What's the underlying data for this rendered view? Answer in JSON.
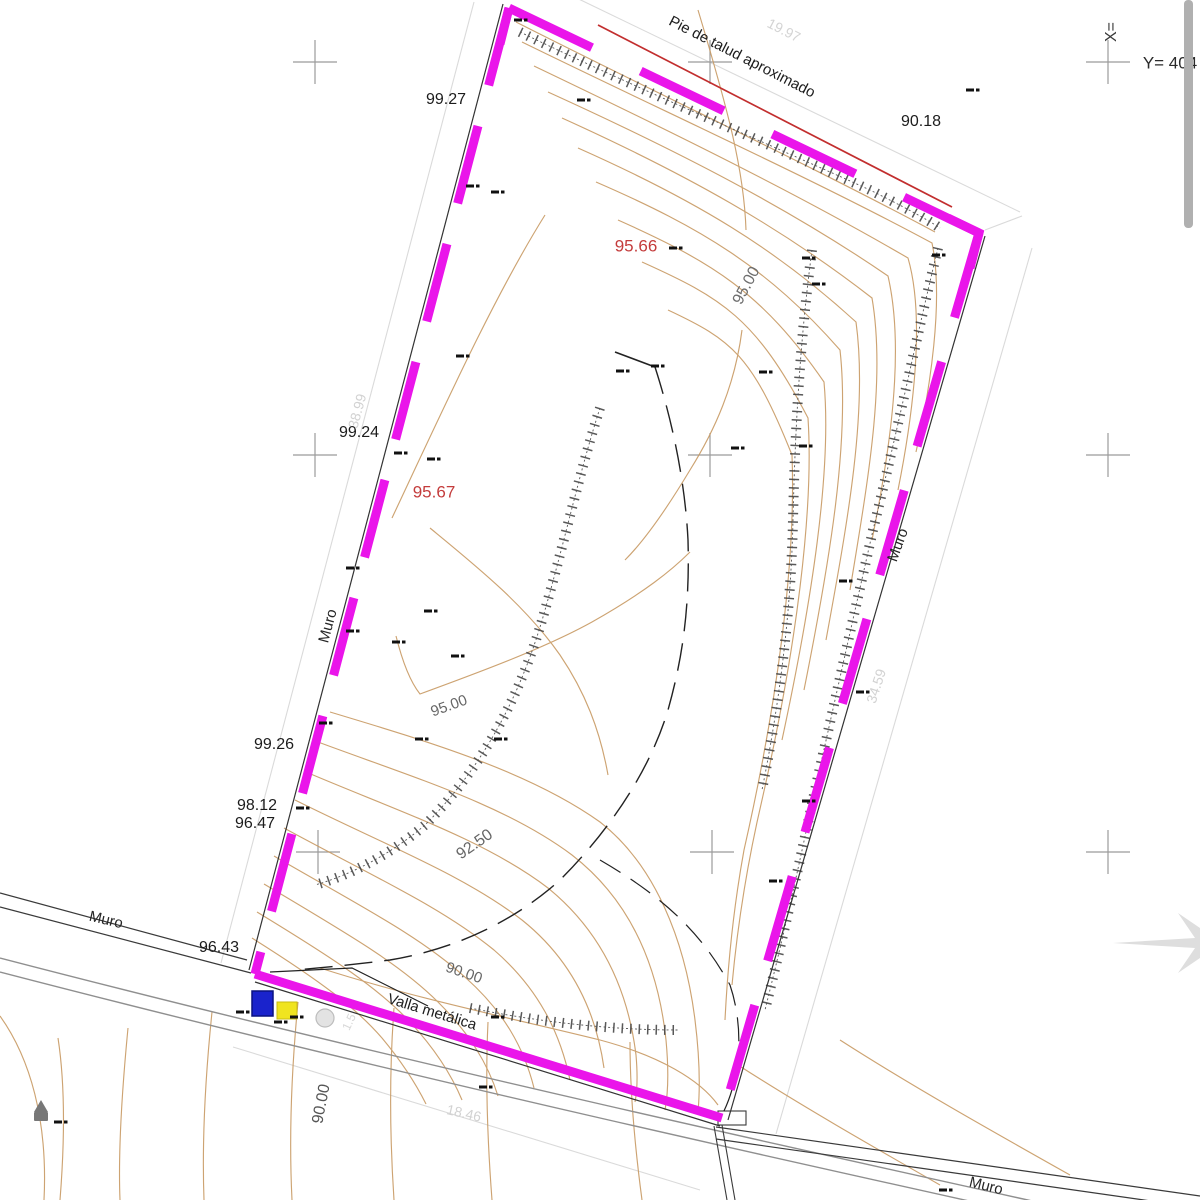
{
  "meta": {
    "title": "Plano topografico - parcela",
    "background": "#ffffff",
    "boundary_color": "#ea15ea",
    "contour_color": "#c89a63",
    "red_line_color": "#c22e2e",
    "dim_color": "#d8d8d8",
    "cross_color": "#9b9b9b"
  },
  "chart_data": {
    "type": "table",
    "title": "Site plan annotations",
    "boundary_side_lengths": {
      "top": 19.97,
      "left": 38.99,
      "right": 34.59,
      "bottom": 18.46
    },
    "contour_levels_labeled": [
      95.0,
      92.5,
      90.0
    ],
    "spot_levels_red": [
      95.66,
      95.67
    ],
    "wall_top_levels_black": [
      99.27,
      99.24,
      99.26,
      98.12,
      96.47,
      96.43,
      90.18
    ],
    "features": [
      "Pie de talud aproximado",
      "Muro",
      "Valla metálica"
    ]
  },
  "coord_labels": {
    "x_label": "X=",
    "y_label": "Y=  404"
  },
  "labels": [
    {
      "name": "label-pie-de-talud",
      "text": "Pie de talud aproximado",
      "x": 742,
      "y": 57,
      "rot": 27,
      "color": "#1c1c1c",
      "size": 15
    },
    {
      "name": "dim-top",
      "text": "19.97",
      "x": 784,
      "y": 30,
      "rot": 27,
      "color": "#d4d4d4",
      "size": 14
    },
    {
      "name": "coord-x",
      "text": "X=",
      "x": 1112,
      "y": 32,
      "rot": -90,
      "color": "#3a3a3a",
      "size": 16
    },
    {
      "name": "coord-y",
      "text": "Y=  404",
      "x": 1170,
      "y": 63,
      "rot": 0,
      "color": "#2a2a2a",
      "size": 17
    },
    {
      "name": "level-90-18",
      "text": "90.18",
      "x": 921,
      "y": 122,
      "rot": 0,
      "color": "#1c1c1c",
      "size": 16
    },
    {
      "name": "level-99-27",
      "text": "99.27",
      "x": 446,
      "y": 100,
      "rot": 0,
      "color": "#1c1c1c",
      "size": 16
    },
    {
      "name": "spot-95-66",
      "text": "95.66",
      "x": 636,
      "y": 246,
      "rot": 0,
      "color": "#c43c3c",
      "size": 17
    },
    {
      "name": "contour-95-upper",
      "text": "95.00",
      "x": 747,
      "y": 286,
      "rot": -62,
      "color": "#6e6e6e",
      "size": 16
    },
    {
      "name": "level-99-24",
      "text": "99.24",
      "x": 359,
      "y": 433,
      "rot": 0,
      "color": "#1c1c1c",
      "size": 16
    },
    {
      "name": "dim-left",
      "text": "38.99",
      "x": 357,
      "y": 411,
      "rot": -75,
      "color": "#d2d2d2",
      "size": 14
    },
    {
      "name": "spot-95-67",
      "text": "95.67",
      "x": 434,
      "y": 492,
      "rot": 0,
      "color": "#c43c3c",
      "size": 17
    },
    {
      "name": "muro-left",
      "text": "Muro",
      "x": 328,
      "y": 626,
      "rot": -75,
      "color": "#262626",
      "size": 15
    },
    {
      "name": "muro-right",
      "text": "Muro",
      "x": 898,
      "y": 545,
      "rot": -70,
      "color": "#262626",
      "size": 15
    },
    {
      "name": "dim-right",
      "text": "34.59",
      "x": 876,
      "y": 686,
      "rot": -72,
      "color": "#d2d2d2",
      "size": 14
    },
    {
      "name": "level-99-26",
      "text": "99.26",
      "x": 274,
      "y": 745,
      "rot": 0,
      "color": "#1c1c1c",
      "size": 16
    },
    {
      "name": "level-98-12",
      "text": "98.12",
      "x": 257,
      "y": 806,
      "rot": 0,
      "color": "#1c1c1c",
      "size": 16
    },
    {
      "name": "level-96-47",
      "text": "96.47",
      "x": 255,
      "y": 824,
      "rot": 0,
      "color": "#1c1c1c",
      "size": 16
    },
    {
      "name": "contour-95-mid",
      "text": "95.00",
      "x": 449,
      "y": 706,
      "rot": -20,
      "color": "#666666",
      "size": 15
    },
    {
      "name": "contour-92-50",
      "text": "92.50",
      "x": 475,
      "y": 845,
      "rot": -35,
      "color": "#666666",
      "size": 16
    },
    {
      "name": "muro-bottom-left",
      "text": "Muro",
      "x": 106,
      "y": 920,
      "rot": 13,
      "color": "#262626",
      "size": 15
    },
    {
      "name": "level-96-43",
      "text": "96.43",
      "x": 219,
      "y": 948,
      "rot": 0,
      "color": "#1c1c1c",
      "size": 16
    },
    {
      "name": "contour-90-mid",
      "text": "90.00",
      "x": 464,
      "y": 973,
      "rot": 19,
      "color": "#666666",
      "size": 15
    },
    {
      "name": "label-valla-metalica",
      "text": "Valla metálica",
      "x": 432,
      "y": 1012,
      "rot": 17,
      "color": "#1c1c1c",
      "size": 15
    },
    {
      "name": "contour-90-low",
      "text": "90.00",
      "x": 322,
      "y": 1104,
      "rot": -79,
      "color": "#555555",
      "size": 16
    },
    {
      "name": "dim-bottom",
      "text": "18.46",
      "x": 464,
      "y": 1113,
      "rot": 13,
      "color": "#d2d2d2",
      "size": 14
    },
    {
      "name": "muro-bottom-right",
      "text": "Muro",
      "x": 986,
      "y": 1186,
      "rot": 14,
      "color": "#262626",
      "size": 15
    },
    {
      "name": "label-1-5",
      "text": "1.5",
      "x": 349,
      "y": 1022,
      "rot": -65,
      "color": "#d8d8d8",
      "size": 12
    }
  ],
  "spot_marks": [
    [
      472,
      186
    ],
    [
      497,
      192
    ],
    [
      583,
      100
    ],
    [
      520,
      20
    ],
    [
      675,
      248
    ],
    [
      972,
      90
    ],
    [
      938,
      255
    ],
    [
      808,
      258
    ],
    [
      818,
      284
    ],
    [
      765,
      372
    ],
    [
      622,
      371
    ],
    [
      657,
      366
    ],
    [
      805,
      446
    ],
    [
      737,
      448
    ],
    [
      462,
      356
    ],
    [
      400,
      453
    ],
    [
      433,
      459
    ],
    [
      352,
      568
    ],
    [
      430,
      611
    ],
    [
      352,
      631
    ],
    [
      398,
      642
    ],
    [
      457,
      656
    ],
    [
      421,
      739
    ],
    [
      500,
      739
    ],
    [
      845,
      581
    ],
    [
      862,
      692
    ],
    [
      808,
      801
    ],
    [
      775,
      881
    ],
    [
      325,
      723
    ],
    [
      302,
      808
    ],
    [
      242,
      1012
    ],
    [
      280,
      1022
    ],
    [
      296,
      1017
    ],
    [
      497,
      1017
    ],
    [
      485,
      1087
    ],
    [
      945,
      1190
    ],
    [
      60,
      1122
    ]
  ],
  "grid_crosses": [
    [
      315,
      62
    ],
    [
      710,
      62
    ],
    [
      1108,
      62
    ],
    [
      315,
      455
    ],
    [
      710,
      455
    ],
    [
      1108,
      455
    ],
    [
      318,
      852
    ],
    [
      712,
      852
    ],
    [
      1108,
      852
    ]
  ],
  "scrollbar": {
    "x": 1184,
    "y": 0,
    "w": 9,
    "h": 228,
    "color": "#b0b0b0"
  },
  "utility_symbols": {
    "blue_box": {
      "x": 252,
      "y": 991,
      "w": 21,
      "h": 25,
      "color": "#1a23cc"
    },
    "yellow_box": {
      "x": 277,
      "y": 1002,
      "w": 20,
      "h": 17,
      "color": "#f0e41f"
    },
    "circle": {
      "cx": 325,
      "cy": 1018,
      "r": 9,
      "color": "#e3e3e3"
    }
  }
}
